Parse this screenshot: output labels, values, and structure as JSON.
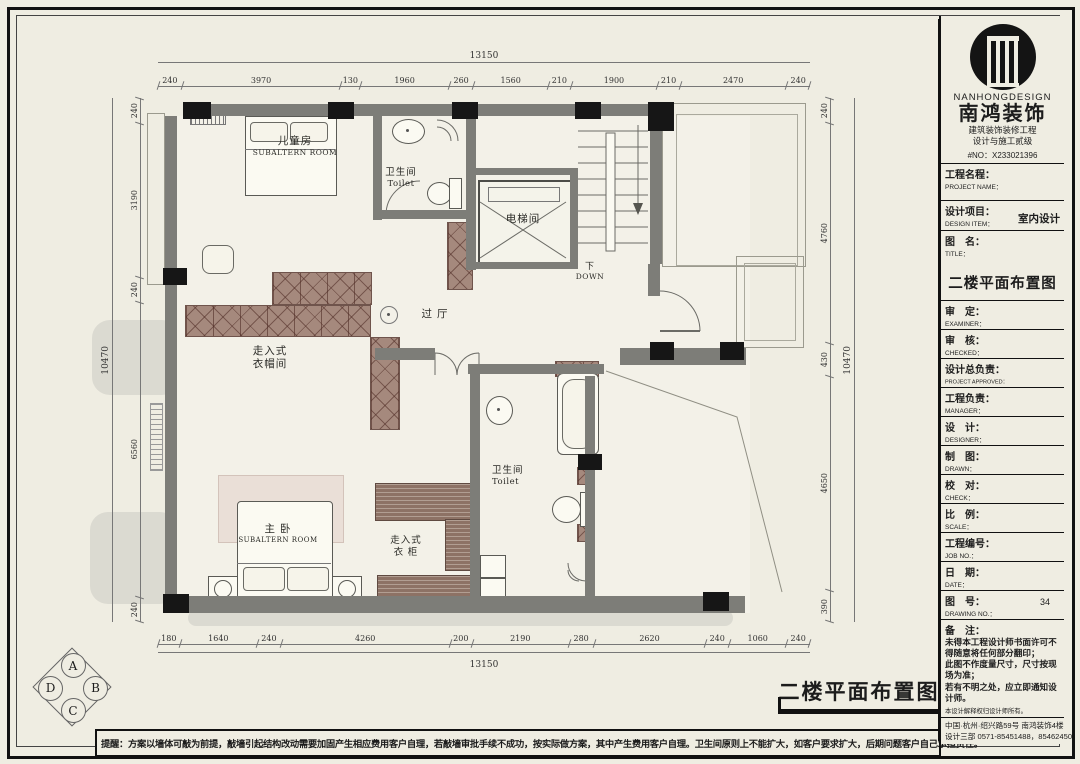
{
  "colors": {
    "paper": "#efede2",
    "wall": "#7d7d78",
    "column": "#161616",
    "hatch": "#a5897d",
    "wood": "#8d7265",
    "shadow": "#dbdad1",
    "accent": "#111111"
  },
  "plan": {
    "rooms": {
      "kids": {
        "l1": "儿童房",
        "l2": "SUBALTERN ROOM"
      },
      "toilet_top": {
        "l1": "卫生间",
        "l2": "Toilet"
      },
      "elevator": {
        "l1": "电梯间"
      },
      "down": {
        "l1": "下",
        "l2": "DOWN"
      },
      "hall": {
        "l1": "过 厅"
      },
      "cloak": {
        "l1": "走入式",
        "l2": "衣帽间"
      },
      "master": {
        "l1": "主 卧",
        "l2": "SUBALTERN ROOM"
      },
      "closet": {
        "l1": "走入式",
        "l2": "衣 柜"
      },
      "toilet_low": {
        "l1": "卫生间",
        "l2": "Toilet"
      }
    },
    "dims": {
      "top": {
        "total": "13150",
        "segs": [
          240,
          3970,
          130,
          1960,
          260,
          1560,
          210,
          1900,
          210,
          2470,
          240
        ]
      },
      "bottom": {
        "total": "13150",
        "segs": [
          180,
          1640,
          240,
          4260,
          200,
          2190,
          280,
          2620,
          240,
          1060,
          240
        ]
      },
      "left": {
        "total": "10470",
        "segs": [
          240,
          3190,
          240,
          6560,
          240
        ]
      },
      "right": {
        "total": "10470",
        "segs": [
          240,
          4760,
          430,
          4650,
          390
        ]
      }
    },
    "compass": {
      "a": "A",
      "b": "B",
      "c": "C",
      "d": "D"
    },
    "stamp": "二楼平面布置图",
    "reminder": "提醒：方案以墙体可敲为前提，敲墙引起结构改动需要加固产生相应费用客户自理，若敲墙审批手续不成功，按实际做方案，其中产生费用客户自理。卫生间原则上不能扩大，如客户要求扩大，后期问题客户自己承担责任。"
  },
  "titleblock": {
    "brand_en": "NANHONGDESIGN",
    "brand_cn": "南鸿装饰",
    "cert1": "建筑装饰装修工程",
    "cert2": "设计与施工贰级",
    "cert_no": "#NO：X233021396",
    "project": {
      "cn": "工程名程：",
      "en": "PROJECT NAME："
    },
    "design_item": {
      "cn": "设计项目：",
      "en": "DESIGN ITEM：",
      "value": "室内设计"
    },
    "drawing_title": {
      "cn": "图　名：",
      "en": "TITLE：",
      "value": "二楼平面布置图"
    },
    "rows": [
      {
        "cn": "审　定：",
        "en": "EXAMINER：",
        "val": ""
      },
      {
        "cn": "审　核：",
        "en": "CHECKED：",
        "val": ""
      },
      {
        "cn": "设计总负责：",
        "en": "PROJECT APPROVED：",
        "val": ""
      },
      {
        "cn": "工程负责：",
        "en": "MANAGER：",
        "val": ""
      },
      {
        "cn": "设　计：",
        "en": "DESIGNER：",
        "val": ""
      },
      {
        "cn": "制　图：",
        "en": "DRAWN：",
        "val": ""
      },
      {
        "cn": "校　对：",
        "en": "CHECK：",
        "val": ""
      },
      {
        "cn": "比　例：",
        "en": "SCALE：",
        "val": ""
      },
      {
        "cn": "工程编号：",
        "en": "JOB NO.：",
        "val": ""
      },
      {
        "cn": "日　期：",
        "en": "DATE：",
        "val": ""
      },
      {
        "cn": "图　号：",
        "en": "DRAWING NO.：",
        "val": "34"
      }
    ],
    "remark": {
      "cn": "备　注：",
      "lines": [
        "未得本工程设计师书面许可不得随意将任何部分翻印；",
        "此图不作度量尺寸，尺寸按现场为准；",
        "若有不明之处，应立即通知设计师。"
      ],
      "small": "本设计解释权归设计师所有。"
    },
    "address": "中国·杭州·绍兴路59号 南鸿装饰4楼",
    "phone": "设计三部 0571-85451488，85462450"
  }
}
